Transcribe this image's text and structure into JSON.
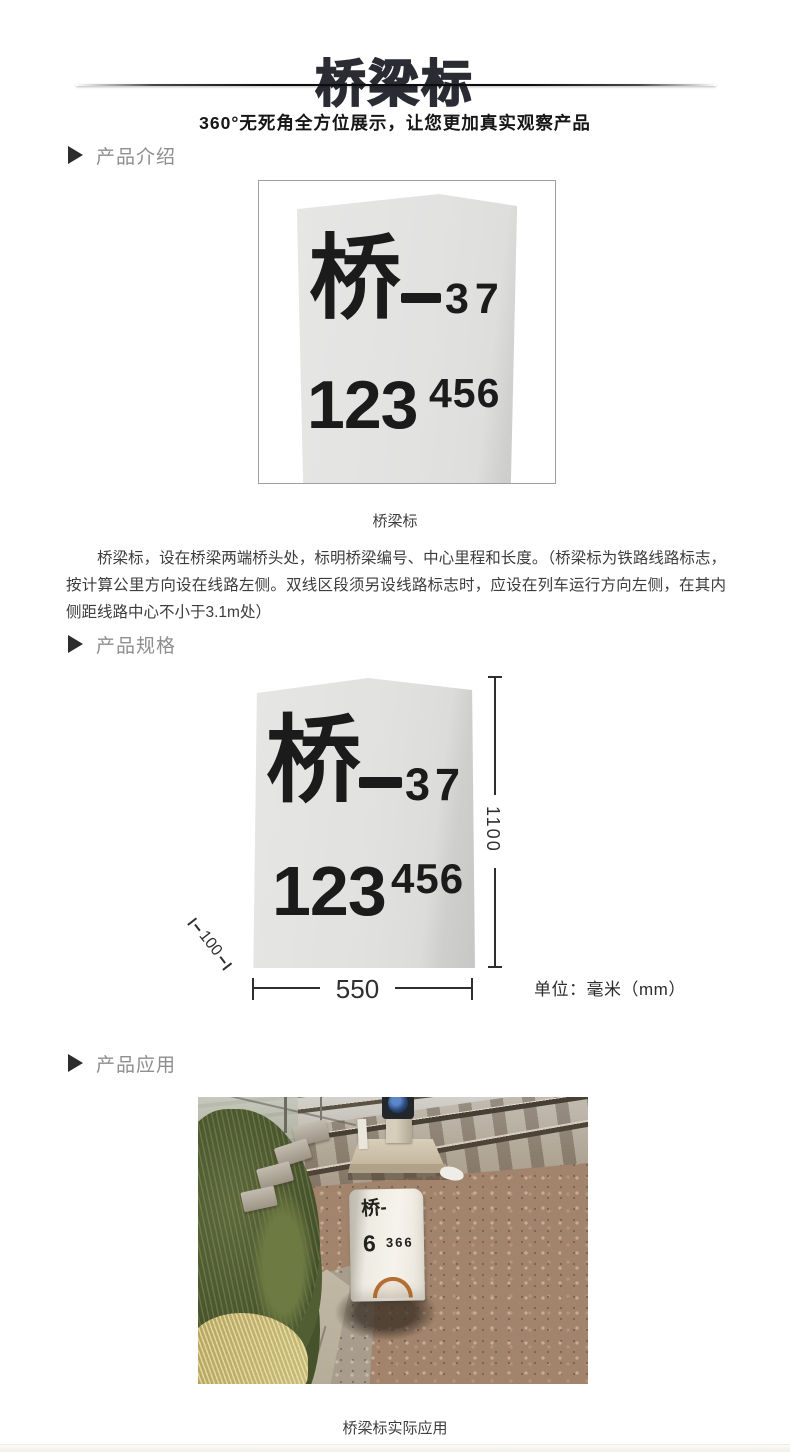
{
  "brand": {
    "title": "桥梁标",
    "subtitle": "360°无死角全方位展示，让您更加真实观察产品"
  },
  "sections": {
    "intro": {
      "heading": "产品介绍",
      "caption": "桥梁标",
      "description": "桥梁标，设在桥梁两端桥头处，标明桥梁编号、中心里程和长度。（桥梁标为铁路线路标志，按计算公里方向设在线路左侧。双线区段须另设线路标志时，应设在列车运行方向左侧，在其内侧距线路中心不小于3.1m处）"
    },
    "spec": {
      "heading": "产品规格",
      "unit_note": "单位：毫米（mm）",
      "dimensions": {
        "height_mm": "1100",
        "width_mm": "550",
        "thickness_mm": "100"
      }
    },
    "application": {
      "heading": "产品应用",
      "caption": "桥梁标实际应用"
    }
  },
  "marker_sign": {
    "prefix": "桥",
    "number": "37",
    "km_main": "123",
    "km_sub": "456"
  },
  "photo_sign": {
    "prefix": "桥-",
    "km_main": "6",
    "km_sub": "366"
  },
  "colors": {
    "title_ink": "#2b2b34",
    "heading_gray": "#8e8e8e",
    "body_text": "#3c3c3c",
    "stone_gray": "#e2e2e1",
    "dim_ink": "#2f2f2f"
  }
}
